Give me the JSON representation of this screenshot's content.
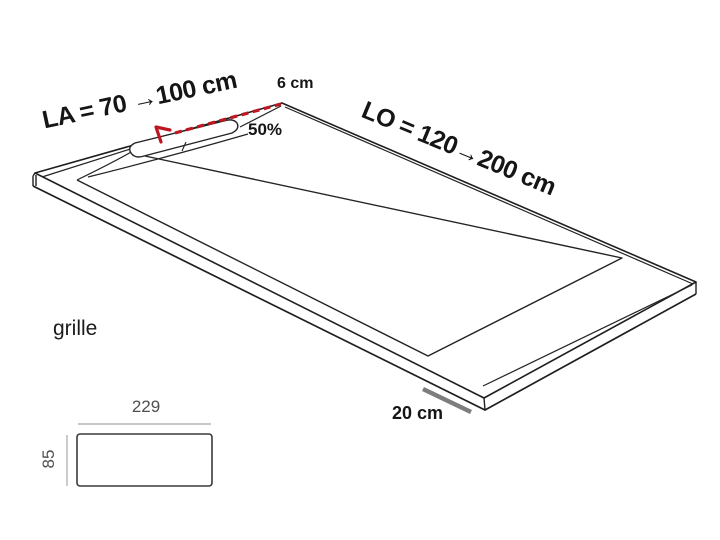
{
  "diagram": {
    "title_hint": "shower tray perspective drawing",
    "tray": {
      "width_label": "LA = 70 →100 cm",
      "length_label": "LO = 120→200 cm",
      "drain_width_label": "6 cm",
      "slope_label": "50%",
      "drain_offset_label": "20 cm"
    },
    "grille": {
      "caption": "grille",
      "width_value": "229",
      "height_value": "85"
    },
    "colors": {
      "outline": "#1f1f1f",
      "red_accent": "#bf1722",
      "measure_gray": "#7d7d7d",
      "dim_line_gray": "#a8a8a8",
      "dim_text_gray": "#4f4f4f",
      "background": "#ffffff"
    }
  }
}
